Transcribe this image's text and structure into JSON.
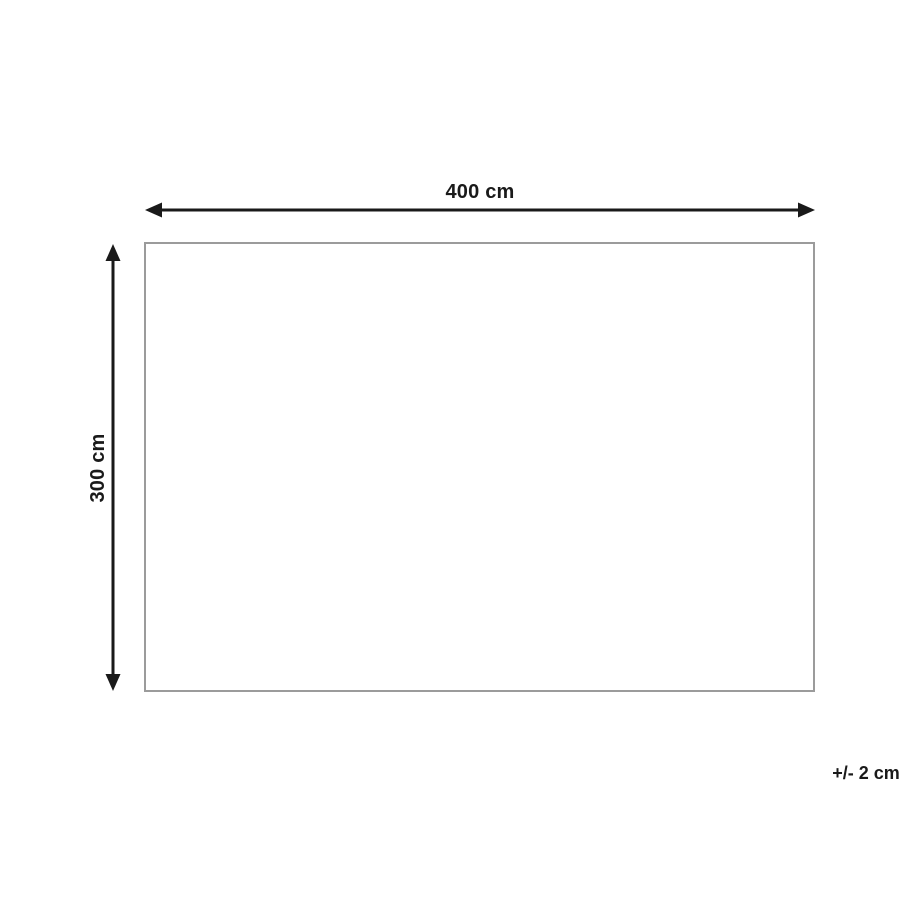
{
  "page": {
    "background": "#ffffff"
  },
  "diagram": {
    "type": "product-dimension-diagram",
    "width_dimension": {
      "label": "400 cm"
    },
    "height_dimension": {
      "label": "300 cm"
    },
    "tolerance": {
      "label": "+/- 2 cm"
    },
    "colors": {
      "dimension_line": "#1a1a1a",
      "outline_border": "#9b9b9b",
      "label_text": "#1a1a1a",
      "background": "#ffffff"
    }
  }
}
